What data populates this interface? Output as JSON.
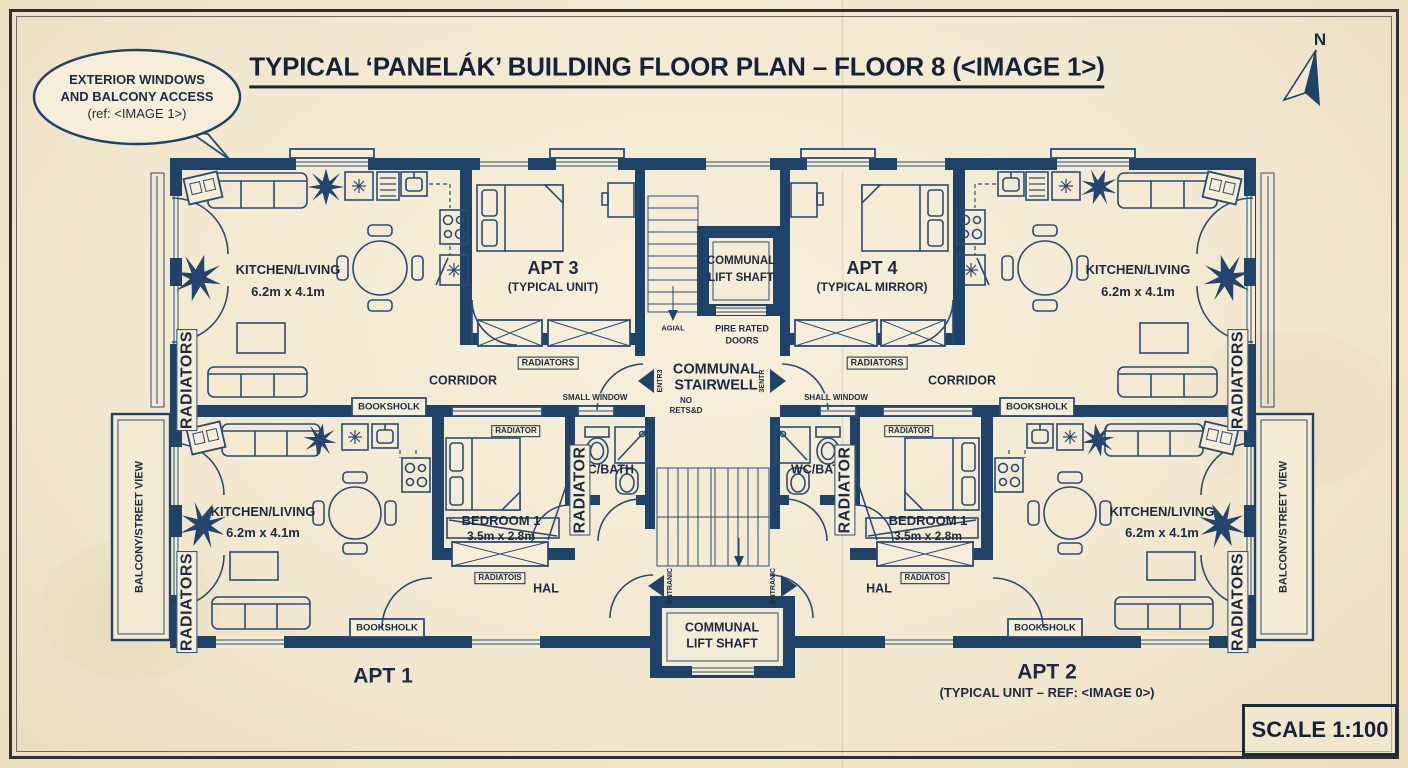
{
  "header": {
    "title": "TYPICAL ‘PANELÁK’ BUILDING FLOOR PLAN – FLOOR 8 (<IMAGE 1>)",
    "north": "N",
    "scale": "SCALE 1:100",
    "callout": {
      "l1": "EXTERIOR WINDOWS",
      "l2": "AND BALCONY ACCESS",
      "l3": "(ref: <IMAGE 1>)"
    }
  },
  "apartments": {
    "a1": "APT 1",
    "a2": "APT 2",
    "a2_sub": "(TYPICAL UNIT – REF: <IMAGE 0>)",
    "a3": "APT 3",
    "a3_sub": "(TYPICAL UNIT)",
    "a4": "APT 4",
    "a4_sub": "(TYPICAL MIRROR)"
  },
  "rooms": {
    "kitchen_living": "KITCHEN/LIVING",
    "kitchen_living_dim": "6.2m x 4.1m",
    "bedroom": "BEDROOM 1",
    "bedroom_dim": "3.5m x 2.8m",
    "wc_bath": "WC/BATH",
    "hal": "HAL",
    "corridor": "CORRIDOR",
    "communal": "COMMUNAL",
    "stairwell": "STAIRWELL",
    "lift_shaft": "LIFT SHAFT",
    "balcony": "BALCONY/STREET VIEW"
  },
  "annotations": {
    "fire1": "PIRE RATED",
    "fire2": "DOORS",
    "no1": "NO",
    "no2": "RETS&D",
    "small_window": "SMALL WINDOW",
    "shall_window": "SHALL WINDOW",
    "bookshelf": "BOOKSHOLK",
    "radiators": "RADIATORS",
    "radiator": "RADIATOR",
    "radiatois": "RADIATOIS",
    "radiatos": "RADIATOS",
    "stair_down": "AGIAL",
    "entry_l": "ENTR3",
    "entry_r": "3ENTR",
    "entrance_l": "ENTRANIC",
    "entrance_r": "ENTRANIC",
    "wall_tag": "RADIATORS"
  }
}
